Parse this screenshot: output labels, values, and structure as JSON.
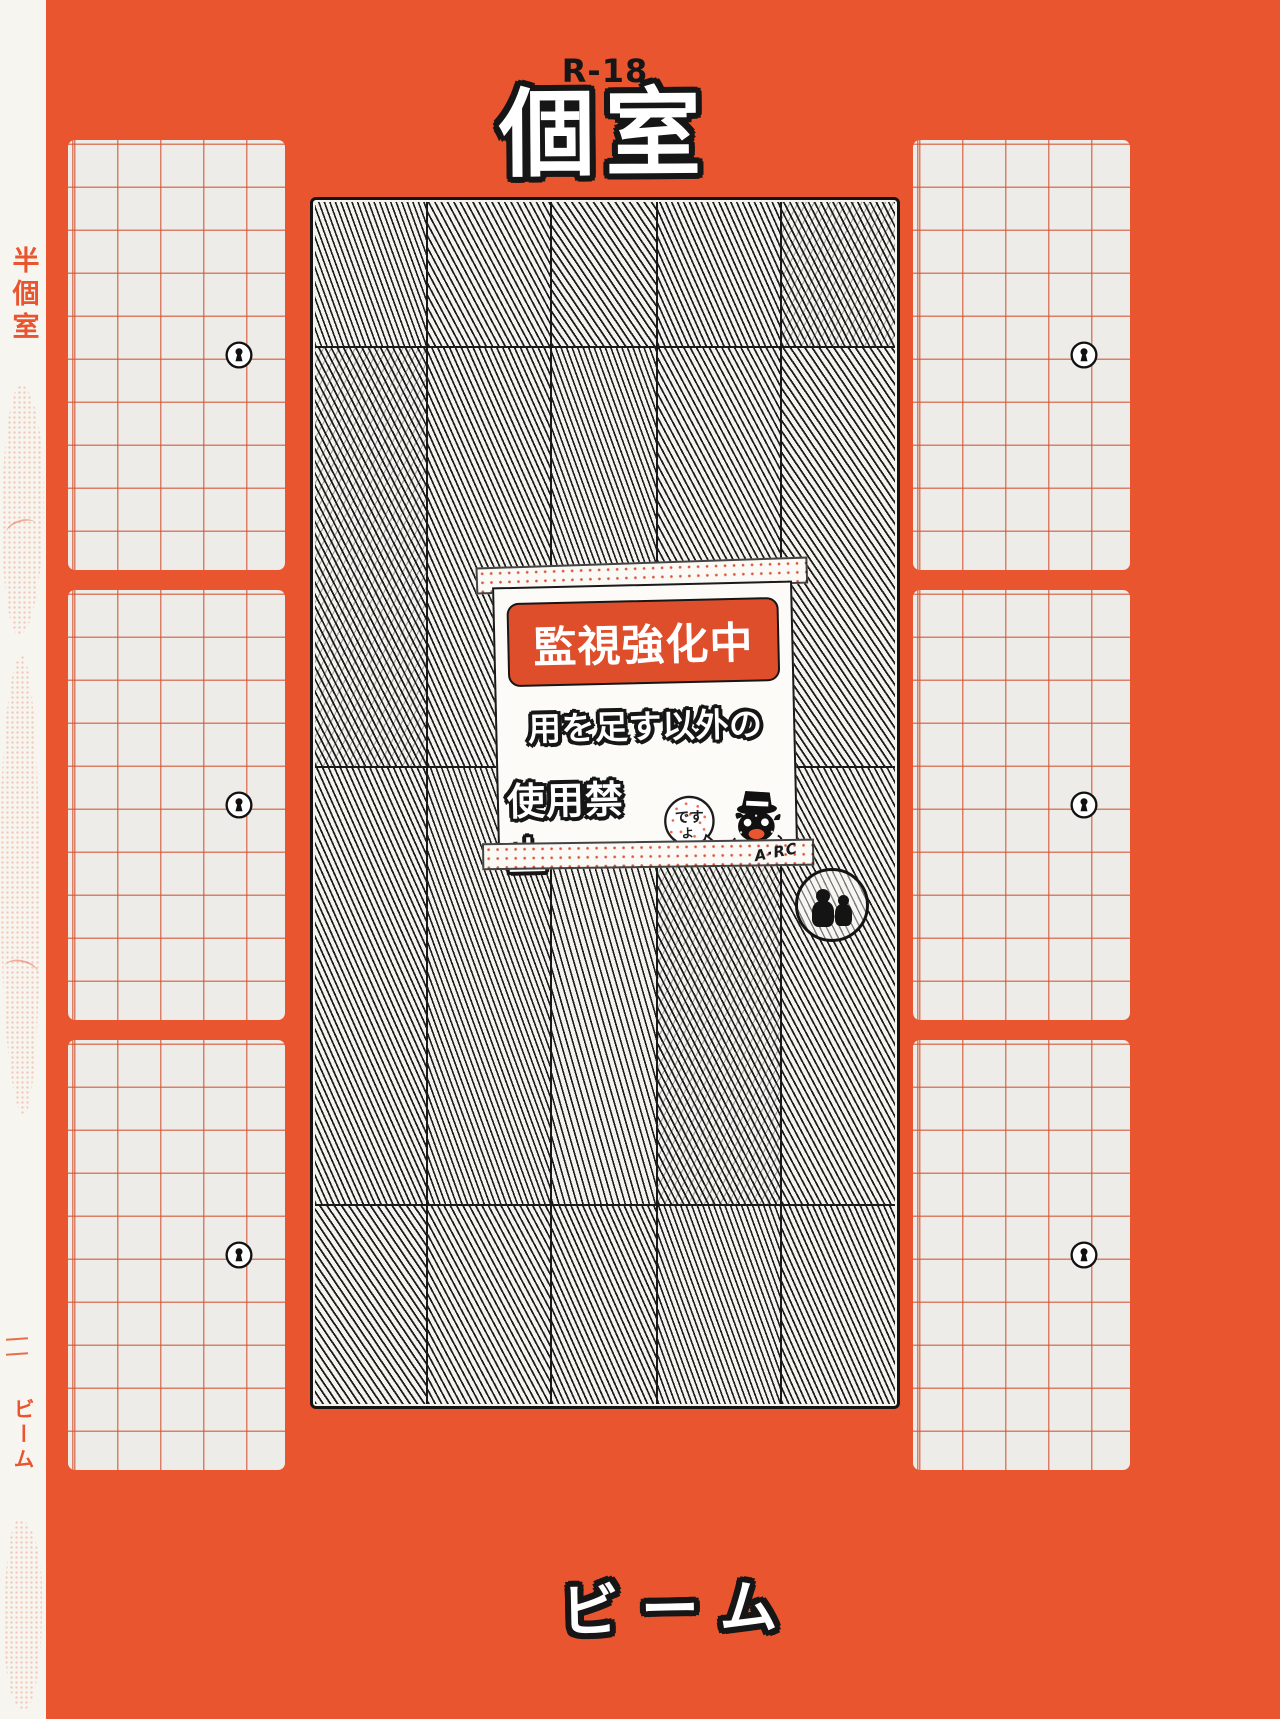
{
  "header": {
    "rating": "R-18",
    "title": "個室"
  },
  "left_strip": {
    "label": "半個室",
    "bottom_label": "ビーム"
  },
  "door": {
    "sign": {
      "banner": "監視強化中",
      "line1": "用を足す以外の",
      "line2": "使用禁止",
      "face_text_top": "です",
      "face_text_bottom": "よ",
      "signature": "A·RC"
    }
  },
  "footer": {
    "publisher": "ビーム"
  },
  "panels": {
    "count": 6,
    "keyhole_icon": "⚿"
  },
  "colors": {
    "background": "#E8552E",
    "banner": "#DF4E2B",
    "grid_line": "#D35230",
    "panel_bg": "#EEECE8",
    "strip_bg": "#F7F5F0",
    "ink": "#161616",
    "paper": "#F5F3EE"
  }
}
